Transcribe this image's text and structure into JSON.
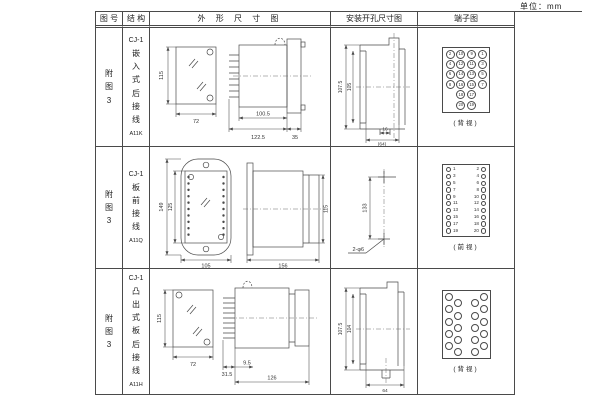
{
  "unit_label": "单位：mm",
  "header": {
    "figure": "图 号",
    "structure": "结 构",
    "outline": "外 形 尺 寸 图",
    "mounting": "安装开孔尺寸图",
    "terminal": "端子图"
  },
  "rows": [
    {
      "figure_no": "附图3",
      "model": "CJ-1",
      "struct": "嵌入式后接线",
      "code": "A11K",
      "dims": {
        "h": "115",
        "w": "72",
        "body": "100.5",
        "total": "122.5",
        "flange": "35"
      },
      "mount": {
        "outer": "107.5",
        "inner": "105",
        "slot": "16",
        "overall": "(64)"
      },
      "terminal": {
        "caption": "(背视)",
        "grid": [
          [
            "2",
            "10",
            "9",
            "1"
          ],
          [
            "4",
            "12",
            "11",
            "3"
          ],
          [
            "6",
            "14",
            "13",
            "5"
          ],
          [
            "8",
            "16",
            "15",
            "7"
          ],
          [
            "18",
            "17"
          ],
          [
            "20",
            "19"
          ]
        ]
      }
    },
    {
      "figure_no": "附图3",
      "model": "CJ-1",
      "struct": "板前接线",
      "code": "A11Q",
      "dims": {
        "outer_h": "149",
        "inner_h": "125",
        "w": "105",
        "len": "156",
        "side_h": "115"
      },
      "mount": {
        "spacing": "133",
        "holes": "2-φ6"
      },
      "terminal": {
        "caption": "(前视)",
        "pairs": [
          [
            "1",
            "2"
          ],
          [
            "3",
            "4"
          ],
          [
            "5",
            "6"
          ],
          [
            "7",
            "8"
          ],
          [
            "9",
            "10"
          ],
          [
            "11",
            "12"
          ],
          [
            "13",
            "14"
          ],
          [
            "15",
            "16"
          ],
          [
            "17",
            "18"
          ],
          [
            "19",
            "20"
          ]
        ]
      }
    },
    {
      "figure_no": "附图3",
      "model": "CJ-1",
      "struct": "凸出式板后接线",
      "code": "A11H",
      "dims": {
        "h": "115",
        "w": "72",
        "pin": "31.5",
        "tip": "9.5",
        "len": "126"
      },
      "mount": {
        "outer": "107.5",
        "inner": "104",
        "width": "64"
      },
      "terminal": {
        "caption": "(背视)",
        "count": 20
      }
    }
  ]
}
